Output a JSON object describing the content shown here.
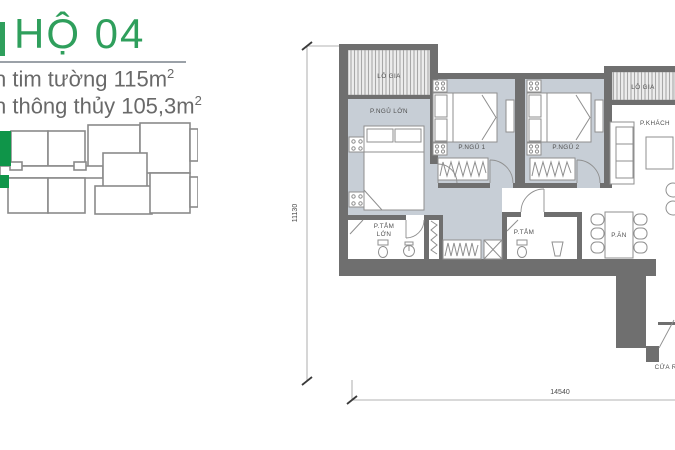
{
  "panel": {
    "title": "HỘ 04",
    "title_color": "#2f9f5c",
    "area_line1": {
      "text": "n tim tường 115m",
      "sup": "2"
    },
    "area_line2": {
      "text": "n thông thủy 105,3m",
      "sup": "2"
    },
    "keyplan": {
      "highlight_color": "#0f9549",
      "outline_color": "#8a8a8a"
    }
  },
  "plan": {
    "labels": {
      "loggia_left": "LÔ GIA",
      "loggia_right": "LÔ GIA",
      "master_bedroom": "P.NGỦ LỚN",
      "bedroom_1": "P.NGỦ 1",
      "bedroom_2": "P.NGỦ 2",
      "living_room": "P.KHÁCH",
      "dining_room": "P.ĂN",
      "master_bath_line1": "P.TẮM",
      "master_bath_line2": "LỚN",
      "bath": "P.TẮM",
      "entrance": "CỬA RA"
    },
    "dimensions": {
      "height": "11130",
      "width": "14540"
    },
    "colors": {
      "wall": "#6f6f6f",
      "room_fill": "#c7ced6",
      "furniture_stroke": "#8f8f8f"
    }
  }
}
